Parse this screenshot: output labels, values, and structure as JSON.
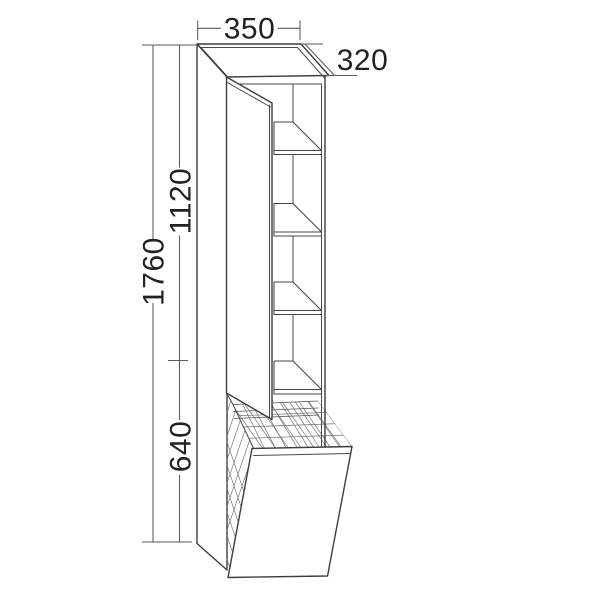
{
  "diagram": {
    "type": "furniture-technical-drawing",
    "subject": "tall-cabinet-with-open-door-shelves-and-tilt-out-laundry-basket",
    "units": "mm",
    "dimensions": {
      "width": {
        "label": "350",
        "orientation": "horizontal-top"
      },
      "depth": {
        "label": "320",
        "orientation": "diagonal-top-right"
      },
      "upper_height": {
        "label": "1120",
        "orientation": "vertical-left-inner"
      },
      "total_height": {
        "label": "1760",
        "orientation": "vertical-left-outer"
      },
      "lower_height": {
        "label": "640",
        "orientation": "vertical-left-inner"
      }
    },
    "features": {
      "shelf_count": 4,
      "door_state": "open",
      "basket": "wire-mesh-tilt-out"
    },
    "colors": {
      "background": "#ffffff",
      "main_line": "#3d3d3d",
      "dimension_line": "#5a5a5a",
      "mesh_line": "#6e6e6e",
      "text": "#222222"
    }
  }
}
